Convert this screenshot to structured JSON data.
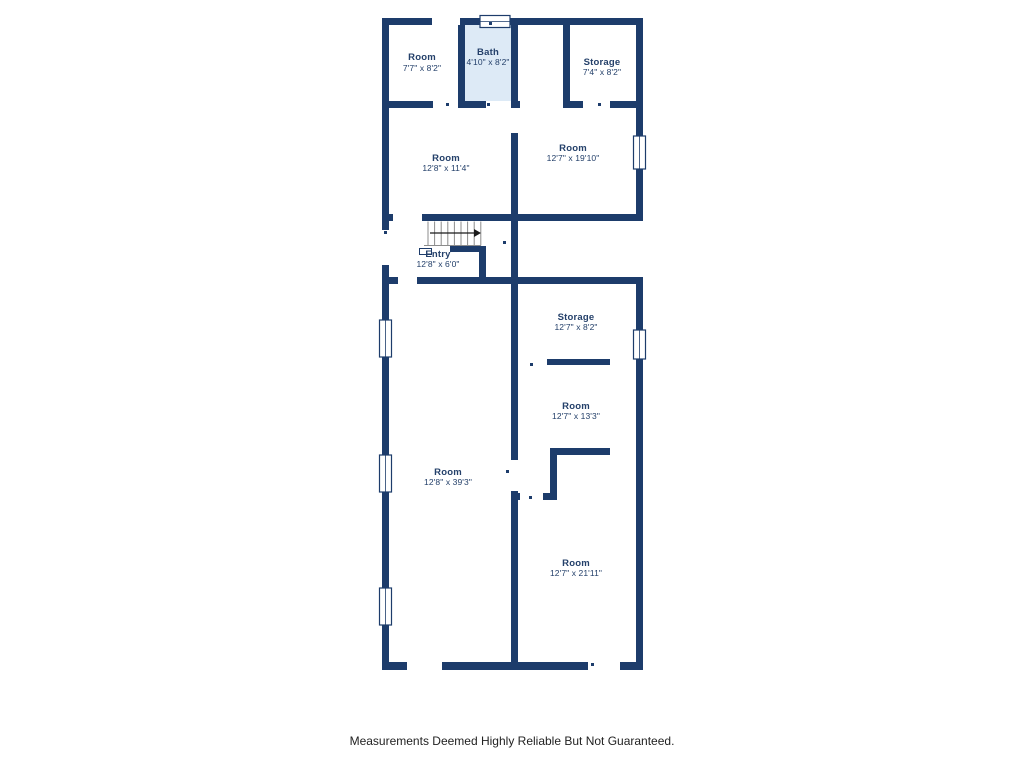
{
  "page": {
    "footer": "Measurements Deemed Highly Reliable But Not Guaranteed."
  },
  "palette": {
    "background": "#ffffff",
    "wall": "#1d3c6b",
    "bath_fill": "#ddeaf6",
    "label_text": "#24406a",
    "footer_text": "#222222",
    "stair_line": "#8c8c8c",
    "arrow": "#1a1a1a"
  },
  "rooms": [
    {
      "id": "room-top-left",
      "name": "Room",
      "dims": "7'7\" x 8'2\"",
      "cx": 422,
      "ny": 60,
      "dy": 71
    },
    {
      "id": "bath",
      "name": "Bath",
      "dims": "4'10\" x 8'2\"",
      "cx": 488,
      "ny": 55,
      "dy": 65
    },
    {
      "id": "storage-top",
      "name": "Storage",
      "dims": "7'4\" x 8'2\"",
      "cx": 602,
      "ny": 65,
      "dy": 75
    },
    {
      "id": "room-mid-left",
      "name": "Room",
      "dims": "12'8\" x 11'4\"",
      "cx": 446,
      "ny": 161,
      "dy": 171
    },
    {
      "id": "room-mid-right",
      "name": "Room",
      "dims": "12'7\" x 19'10\"",
      "cx": 573,
      "ny": 151,
      "dy": 161
    },
    {
      "id": "entry",
      "name": "Entry",
      "dims": "12'8\" x 6'0\"",
      "cx": 438,
      "ny": 257,
      "dy": 267
    },
    {
      "id": "storage-lower",
      "name": "Storage",
      "dims": "12'7\" x 8'2\"",
      "cx": 576,
      "ny": 320,
      "dy": 330
    },
    {
      "id": "room-right-mid",
      "name": "Room",
      "dims": "12'7\" x 13'3\"",
      "cx": 576,
      "ny": 409,
      "dy": 419
    },
    {
      "id": "room-big-left",
      "name": "Room",
      "dims": "12'8\" x 39'3\"",
      "cx": 448,
      "ny": 475,
      "dy": 485
    },
    {
      "id": "room-bottom-right",
      "name": "Room",
      "dims": "12'7\" x 21'11\"",
      "cx": 576,
      "ny": 566,
      "dy": 576
    }
  ]
}
